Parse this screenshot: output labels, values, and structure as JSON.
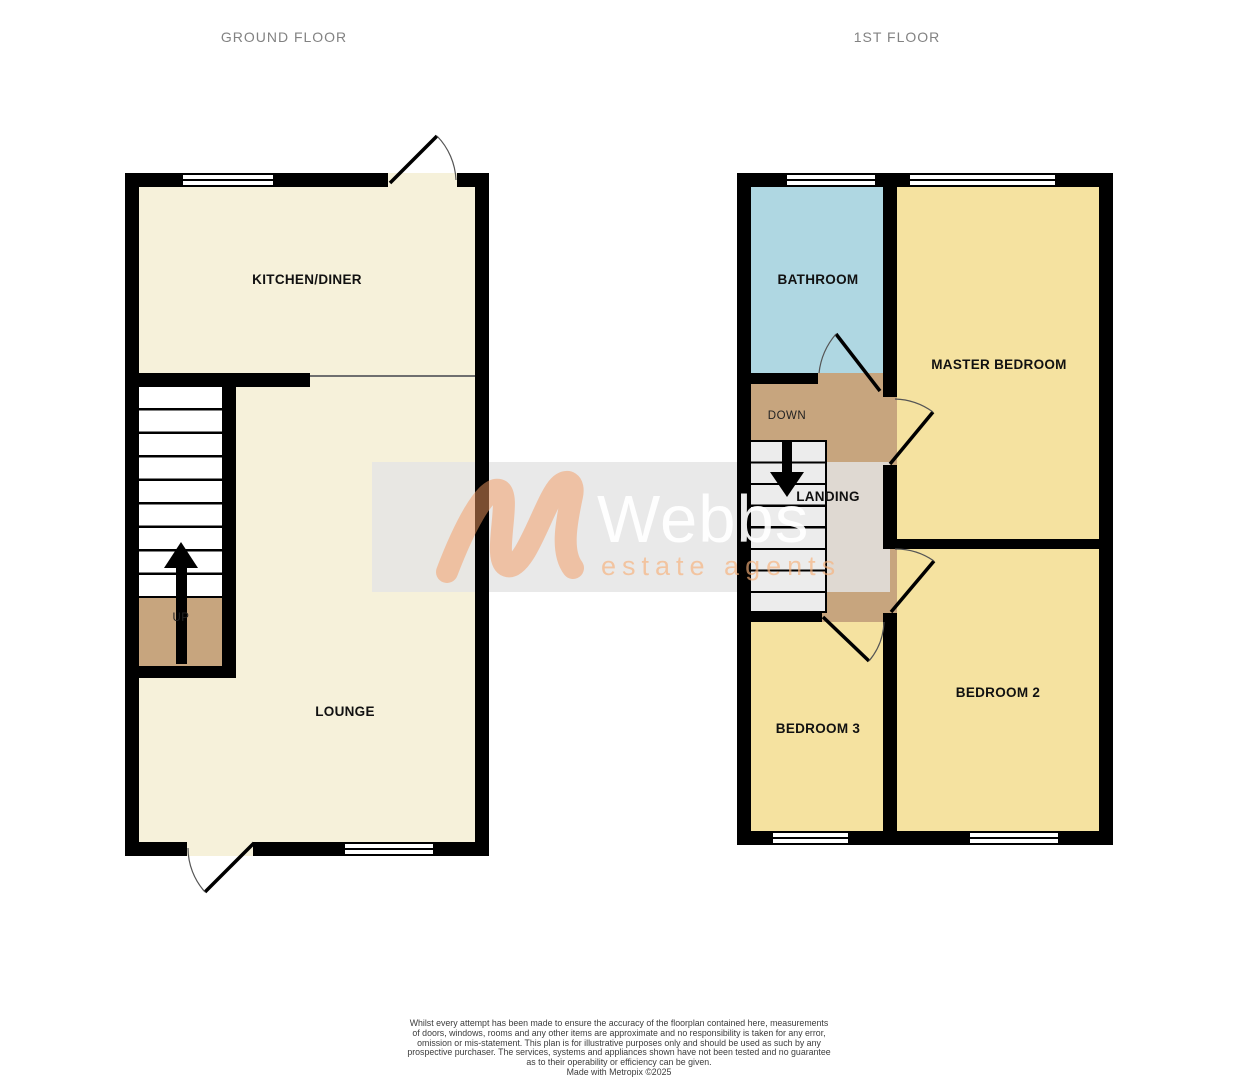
{
  "titles": {
    "ground": "GROUND FLOOR",
    "first": "1ST FLOOR"
  },
  "rooms": {
    "kitchen": "KITCHEN/DINER",
    "lounge": "LOUNGE",
    "up": "UP",
    "bathroom": "BATHROOM",
    "master": "MASTER BEDROOM",
    "landing": "LANDING",
    "down": "DOWN",
    "bedroom2": "BEDROOM 2",
    "bedroom3": "BEDROOM 3"
  },
  "watermark": {
    "brand": "Webbs",
    "tagline": "estate agents",
    "monogram_icon": "script-w-icon"
  },
  "disclaimer": {
    "lines": [
      "Whilst every attempt has been made to ensure the accuracy of the floorplan contained here, measurements",
      "of doors, windows, rooms and any other items are approximate and no responsibility is taken for any error,",
      "omission or mis-statement. This plan is for illustrative purposes only and should be used as such by any",
      "prospective purchaser. The services, systems and appliances shown have not been tested and no guarantee",
      "as to their operability or efficiency can be given.",
      "Made with Metropix ©2025"
    ]
  },
  "colors": {
    "cream": "#F6F1DA",
    "bedroom": "#F5E2A0",
    "bathroom": "#AFD7E2",
    "landing": "#C7A57E",
    "wall": "#000000",
    "title_gray": "#828282",
    "logo_orange": "#F49A5F"
  }
}
